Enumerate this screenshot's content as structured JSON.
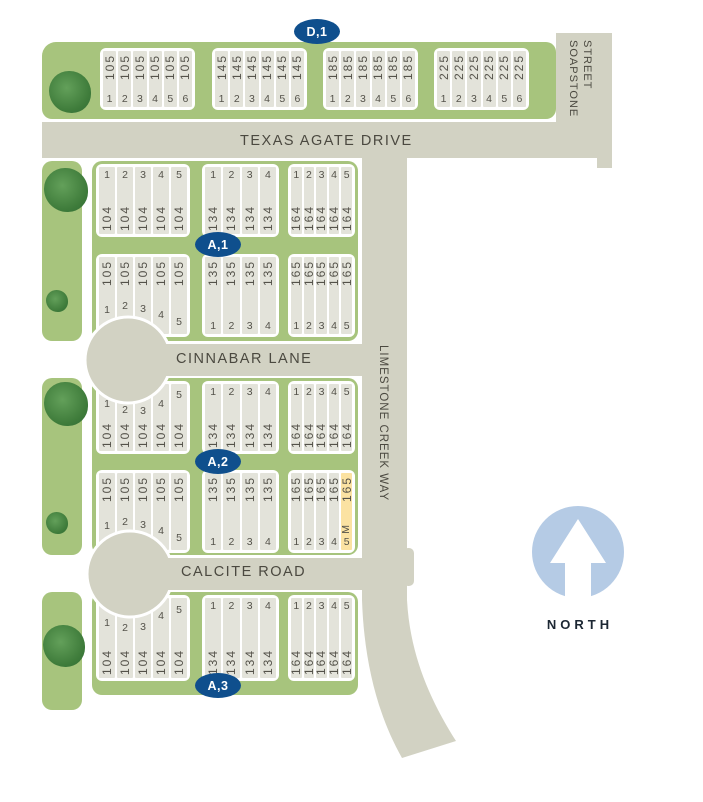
{
  "streets": {
    "texas_agate": "TEXAS AGATE DRIVE",
    "cinnabar": "CINNABAR LANE",
    "calcite": "CALCITE ROAD",
    "limestone": "LIMESTONE CREEK WAY",
    "soapstone_line1": "SOAPSTONE",
    "soapstone_line2": "STREET"
  },
  "north_label": "NORTH",
  "blocks": [
    {
      "badge": "D,1",
      "rows": [
        {
          "numbers_position": "bottom",
          "groups": [
            {
              "sqft": "105",
              "lots": [
                "1",
                "2",
                "3",
                "4",
                "5",
                "6"
              ]
            },
            {
              "sqft": "145",
              "lots": [
                "1",
                "2",
                "3",
                "4",
                "5",
                "6"
              ]
            },
            {
              "sqft": "185",
              "lots": [
                "1",
                "2",
                "3",
                "4",
                "5",
                "6"
              ]
            },
            {
              "sqft": "225",
              "lots": [
                "1",
                "2",
                "3",
                "4",
                "5",
                "6"
              ]
            }
          ]
        }
      ]
    },
    {
      "badge": "A,1",
      "rows": [
        {
          "numbers_position": "top",
          "groups": [
            {
              "sqft": "104",
              "lots": [
                "1",
                "2",
                "3",
                "4",
                "5"
              ]
            },
            {
              "sqft": "134",
              "lots": [
                "1",
                "2",
                "3",
                "4"
              ]
            },
            {
              "sqft": "164",
              "lots": [
                "1",
                "2",
                "3",
                "4",
                "5"
              ]
            }
          ]
        },
        {
          "numbers_position": "bottom",
          "groups": [
            {
              "sqft": "105",
              "lots": [
                "1",
                "2",
                "3",
                "4",
                "5"
              ]
            },
            {
              "sqft": "135",
              "lots": [
                "1",
                "2",
                "3",
                "4"
              ]
            },
            {
              "sqft": "165",
              "lots": [
                "1",
                "2",
                "3",
                "4",
                "5"
              ]
            }
          ]
        }
      ]
    },
    {
      "badge": "A,2",
      "rows": [
        {
          "numbers_position": "top",
          "groups": [
            {
              "sqft": "104",
              "lots": [
                "1",
                "2",
                "3",
                "4",
                "5"
              ]
            },
            {
              "sqft": "134",
              "lots": [
                "1",
                "2",
                "3",
                "4"
              ]
            },
            {
              "sqft": "164",
              "lots": [
                "1",
                "2",
                "3",
                "4",
                "5"
              ]
            }
          ]
        },
        {
          "numbers_position": "bottom",
          "groups": [
            {
              "sqft": "105",
              "lots": [
                "1",
                "2",
                "3",
                "4",
                "5"
              ]
            },
            {
              "sqft": "135",
              "lots": [
                "1",
                "2",
                "3",
                "4"
              ]
            },
            {
              "sqft": "165",
              "lots": [
                "1",
                "2",
                "3",
                "4",
                "5"
              ],
              "model_lot": {
                "index": 4,
                "marker": "M"
              }
            }
          ]
        }
      ]
    },
    {
      "badge": "A,3",
      "rows": [
        {
          "numbers_position": "top",
          "groups": [
            {
              "sqft": "104",
              "lots": [
                "1",
                "2",
                "3",
                "4",
                "5"
              ]
            },
            {
              "sqft": "134",
              "lots": [
                "1",
                "2",
                "3",
                "4"
              ]
            },
            {
              "sqft": "164",
              "lots": [
                "1",
                "2",
                "3",
                "4",
                "5"
              ]
            }
          ]
        }
      ]
    }
  ],
  "colors": {
    "road": "#d2d2c3",
    "green": "#a7c47d",
    "lot_fill": "#e3e3da",
    "lot_text": "#54524a",
    "street_text": "#4b4940",
    "badge_blue": "#0f4f8d",
    "model_yellow": "#fbe2a2",
    "north_circle": "#b5cbe5",
    "tree_green": "#3f7c3b"
  }
}
